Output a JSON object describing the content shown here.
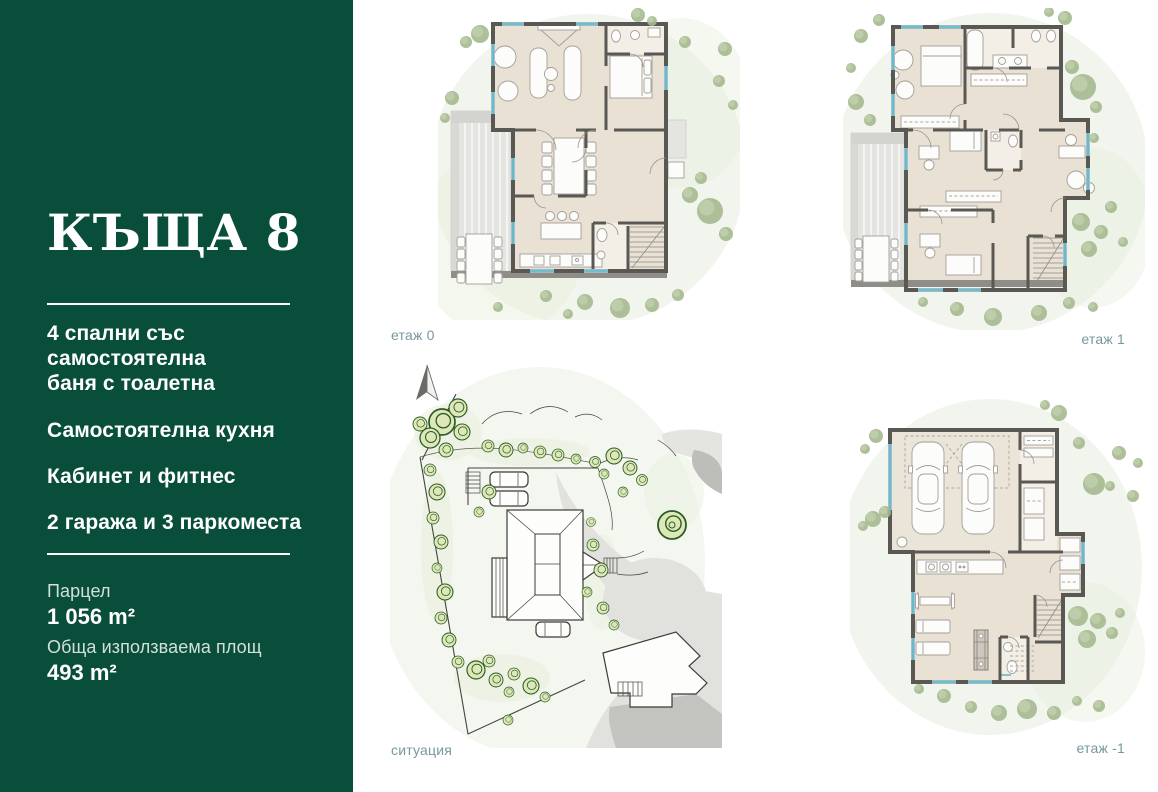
{
  "sidebar": {
    "title": "КЪЩА 8",
    "features": [
      "4 спални със\nсамостоятелна\nбаня с тоалетна",
      "Самостоятелна кухня",
      "Кабинет и фитнес",
      "2 гаража и 3 паркоместа"
    ],
    "specs": [
      {
        "label": "Парцел",
        "value": "1 056 m²"
      },
      {
        "label": "Обща използваема площ",
        "value": "493 m²"
      }
    ]
  },
  "plans": {
    "items": [
      {
        "caption": "етаж 0"
      },
      {
        "caption": "етаж 1"
      },
      {
        "caption": "ситуация"
      },
      {
        "caption": "етаж -1"
      }
    ]
  },
  "colors": {
    "sidebar_green": "#094e3a",
    "caption_teal": "#76989d",
    "wall_gray": "#5a5853",
    "floor_beige": "#e8e1d4",
    "window_blue": "#2f9cb8",
    "tree_green": "#a4b98e",
    "site_tree_green": "#2e5b25",
    "road_gray": "#e1e1de"
  }
}
